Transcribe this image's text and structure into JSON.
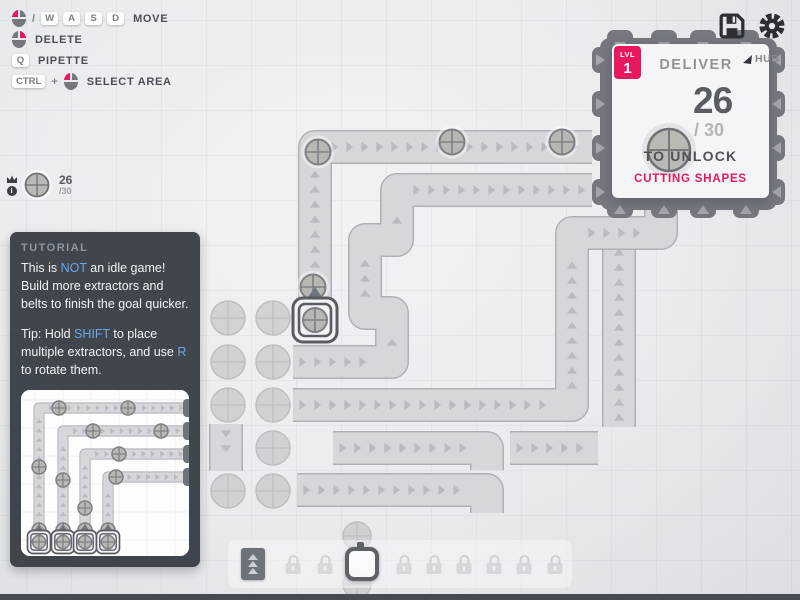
{
  "colors": {
    "accent_pink": "#e8185e",
    "accent_blue": "#6aa6e8",
    "belt_fill": "#d5d7da",
    "belt_border": "#aeb1b7",
    "chevron": "#b0b4ba",
    "item_fill": "#b7b8b3",
    "item_stroke": "#7e8085",
    "deposit": "#c9cbcf",
    "hub_body": "#75787f",
    "hub_arrow": "#a3a6ac",
    "dark_icon": "#2c2f34"
  },
  "hints": {
    "rows": [
      {
        "tokens": [
          "mouse-left",
          "text:/",
          "key:W",
          "key:A",
          "key:S",
          "key:D"
        ],
        "label": "MOVE"
      },
      {
        "tokens": [
          "mouse-right"
        ],
        "label": "DELETE"
      },
      {
        "tokens": [
          "key:Q"
        ],
        "label": "PIPETTE"
      },
      {
        "tokens": [
          "key:CTRL",
          "text:+",
          "mouse-left"
        ],
        "label": "SELECT AREA"
      }
    ]
  },
  "goal_pin": {
    "shape": "circle",
    "current": "26",
    "total": "/30"
  },
  "hub_panel": {
    "level_label": "LVL",
    "level": "1",
    "title": "DELIVER",
    "marker_label": "HUB",
    "shape": "circle",
    "current": "26",
    "total": "/ 30",
    "unlock_text": "TO UNLOCK",
    "reward": "CUTTING SHAPES"
  },
  "tutorial": {
    "title": "TUTORIAL",
    "paragraphs": [
      [
        {
          "t": "This is "
        },
        {
          "t": "NOT",
          "c": "b"
        },
        {
          "t": " an idle game! Build more extractors and belts to finish the goal quicker."
        }
      ],
      [
        {
          "t": "Tip: Hold "
        },
        {
          "t": "SHIFT",
          "c": "b"
        },
        {
          "t": " to place multiple extractors, and use "
        },
        {
          "t": "R",
          "c": "b"
        },
        {
          "t": " to rotate them."
        }
      ]
    ]
  },
  "toolbar": {
    "slots": [
      {
        "type": "belt",
        "x": 253,
        "state": "active"
      },
      {
        "type": "locked",
        "x": 293
      },
      {
        "type": "locked",
        "x": 325
      },
      {
        "type": "extractor",
        "x": 362,
        "state": "selected"
      },
      {
        "type": "locked",
        "x": 404
      },
      {
        "type": "locked",
        "x": 434
      },
      {
        "type": "locked",
        "x": 464
      },
      {
        "type": "locked",
        "x": 494
      },
      {
        "type": "locked",
        "x": 524
      },
      {
        "type": "locked",
        "x": 555
      }
    ]
  },
  "world": {
    "grid_size": 45,
    "belts": [
      {
        "id": "belt-inner-to-hub",
        "points": [
          [
            619,
            427
          ],
          [
            619,
            232
          ]
        ]
      },
      {
        "id": "belt-main-to-hub-top",
        "points": [
          [
            315,
            334
          ],
          [
            315,
            147
          ],
          [
            592,
            147
          ]
        ]
      },
      {
        "id": "belt-serpentine-to-hub",
        "points": [
          [
            293,
            362
          ],
          [
            392,
            362
          ],
          [
            392,
            313
          ],
          [
            365,
            313
          ],
          [
            365,
            240
          ],
          [
            397,
            240
          ],
          [
            397,
            190
          ],
          [
            592,
            190
          ]
        ]
      },
      {
        "id": "belt-long-row-to-hub-bottom",
        "points": [
          [
            293,
            405
          ],
          [
            572,
            405
          ],
          [
            572,
            233
          ],
          [
            661,
            233
          ],
          [
            661,
            206
          ]
        ]
      },
      {
        "id": "belt-row-4",
        "points": [
          [
            333,
            448
          ],
          [
            487,
            448
          ],
          [
            487,
            470
          ]
        ]
      },
      {
        "id": "belt-piece",
        "points": [
          [
            510,
            448
          ],
          [
            598,
            448
          ]
        ]
      },
      {
        "id": "belt-row-5",
        "points": [
          [
            297,
            490
          ],
          [
            487,
            490
          ],
          [
            487,
            513
          ]
        ]
      },
      {
        "id": "belt-down-piece",
        "points": [
          [
            226,
            424
          ],
          [
            226,
            471
          ]
        ]
      }
    ],
    "items": [
      [
        318,
        152
      ],
      [
        452,
        142
      ],
      [
        562,
        142
      ],
      [
        313,
        287
      ]
    ],
    "deposits": [
      [
        228,
        318
      ],
      [
        273,
        318
      ],
      [
        228,
        362
      ],
      [
        273,
        362
      ],
      [
        228,
        405
      ],
      [
        273,
        405
      ],
      [
        273,
        448
      ],
      [
        228,
        491
      ],
      [
        273,
        491
      ]
    ],
    "small_deposits": [
      [
        357,
        536
      ],
      [
        357,
        584
      ]
    ],
    "extractor": {
      "x": 315,
      "y": 320
    },
    "hub": {
      "x": 600,
      "y": 38,
      "w": 177,
      "h": 172,
      "tabs_x": [
        620,
        664,
        703,
        746
      ],
      "tabs_y": [
        60,
        104,
        148,
        192
      ]
    }
  },
  "illustration": {
    "belts": [
      {
        "points": [
          [
            18,
            158
          ],
          [
            18,
            18
          ],
          [
            168,
            18
          ]
        ]
      },
      {
        "points": [
          [
            42,
            158
          ],
          [
            42,
            41
          ],
          [
            168,
            41
          ]
        ]
      },
      {
        "points": [
          [
            64,
            158
          ],
          [
            64,
            64
          ],
          [
            168,
            64
          ]
        ]
      },
      {
        "points": [
          [
            87,
            158
          ],
          [
            87,
            87
          ],
          [
            168,
            87
          ]
        ]
      }
    ],
    "stubs": [
      [
        162,
        18
      ],
      [
        162,
        41
      ],
      [
        162,
        64
      ],
      [
        162,
        87
      ]
    ],
    "items": [
      [
        38,
        18
      ],
      [
        107,
        18
      ],
      [
        72,
        41
      ],
      [
        140,
        41
      ],
      [
        98,
        64
      ],
      [
        95,
        87
      ],
      [
        18,
        77
      ],
      [
        42,
        90
      ],
      [
        64,
        118
      ],
      [
        18,
        140
      ],
      [
        42,
        140
      ],
      [
        64,
        140
      ],
      [
        87,
        140
      ]
    ],
    "extractors": [
      [
        18,
        152
      ],
      [
        42,
        152
      ],
      [
        64,
        152
      ],
      [
        87,
        152
      ]
    ]
  }
}
